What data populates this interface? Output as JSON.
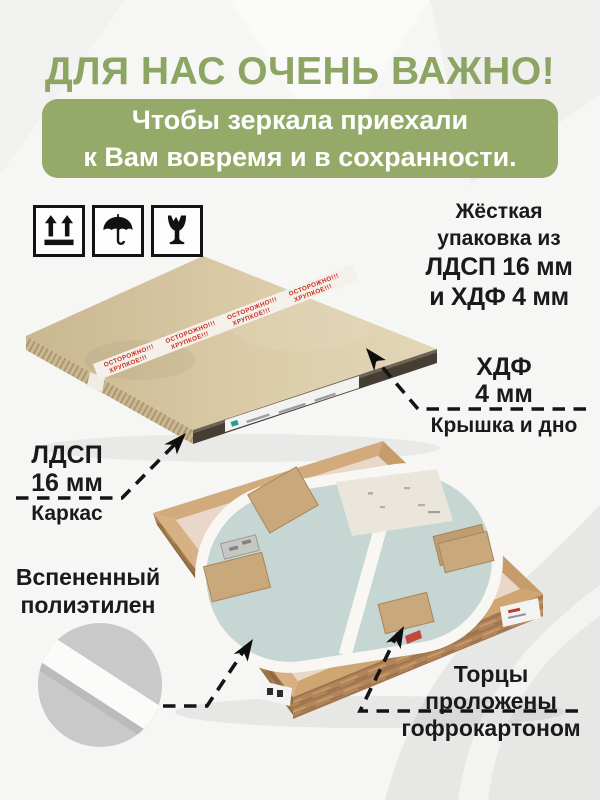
{
  "header": {
    "title": "ДЛЯ НАС ОЧЕНЬ ВАЖНО!",
    "banner_line1": "Чтобы зеркала приехали",
    "banner_line2": "к Вам вовремя и в сохранности."
  },
  "handling_icons": [
    {
      "name": "this-way-up-icon"
    },
    {
      "name": "keep-dry-icon"
    },
    {
      "name": "fragile-icon"
    }
  ],
  "closed_package": {
    "tape_warning_line1": "ОСТОРОЖНО!!!",
    "tape_warning_line2": "ХРУПКОЕ!!!"
  },
  "annotations": {
    "rigid_packaging": {
      "line1": "Жёсткая",
      "line2": "упаковка из",
      "line3": "ЛДСП 16 мм",
      "line4": "и ХДФ 4 мм"
    },
    "hdf": {
      "material": "ХДФ",
      "thickness": "4 мм",
      "caption": "Крышка и дно"
    },
    "ldsp": {
      "material": "ЛДСП",
      "thickness": "16 мм",
      "caption": "Каркас"
    },
    "foam": {
      "line1": "Вспененный",
      "line2": "полиэтилен"
    },
    "edges": {
      "line1": "Торцы",
      "line2": "проложены",
      "line3": "гофрокартоном"
    }
  },
  "colors": {
    "accent_green": "#95aa68",
    "title_green": "#8ca563",
    "text_black": "#1a1a1a",
    "tape_red": "#cc2a1f",
    "kraft_board": "#d8c7a4",
    "wood_frame": "#b2855a",
    "mirror_back": "#c6d6d2",
    "foam_white": "#f8f7f4",
    "detail_circle_gray": "#c9c9c9"
  }
}
